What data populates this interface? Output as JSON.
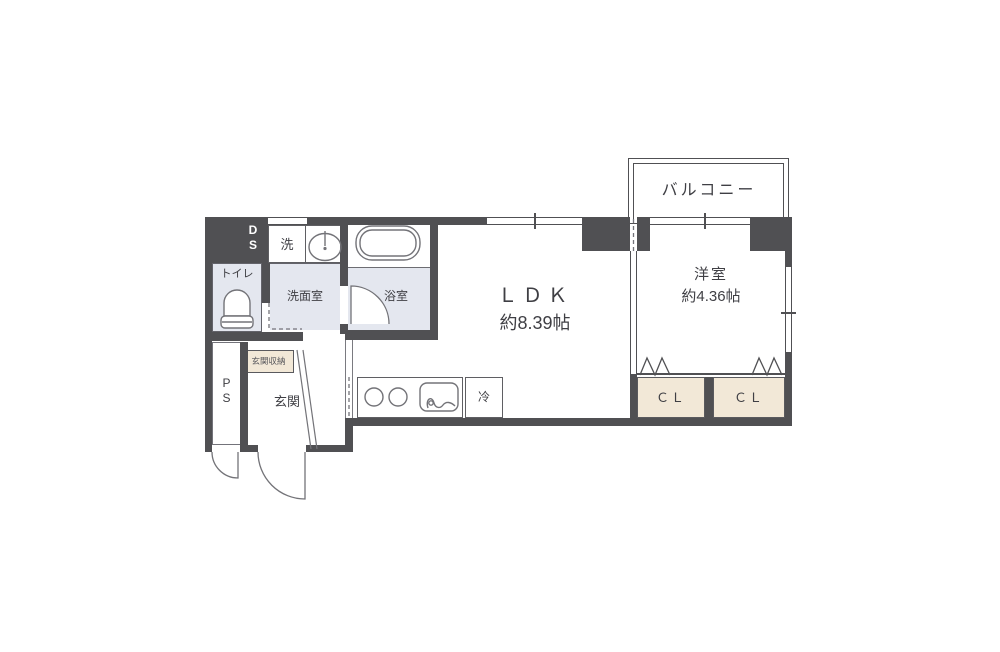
{
  "floor_plan": {
    "balcony": {
      "label": "バルコニー"
    },
    "western_room": {
      "label": "洋室",
      "size": "約4.36帖"
    },
    "ldk": {
      "label": "ＬＤＫ",
      "size": "約8.39帖"
    },
    "closet_left": {
      "label": "ＣＬ"
    },
    "closet_right": {
      "label": "ＣＬ"
    },
    "toilet": {
      "label": "トイレ"
    },
    "washroom": {
      "label": "洗面室"
    },
    "bathroom": {
      "label": "浴室"
    },
    "washer": {
      "label": "洗"
    },
    "fridge": {
      "label": "冷"
    },
    "entrance": {
      "label": "玄関"
    },
    "entrance_storage": {
      "label": "玄関収納"
    },
    "pipe_space": {
      "line1": "P",
      "line2": "S"
    },
    "duct_space": {
      "line1": "D",
      "line2": "S"
    },
    "fixtures": {
      "bathtub": "bathtub-icon",
      "washbasin": "sink-icon",
      "toilet_bowl": "toilet-icon",
      "stove_burners": "stove-burners-icon",
      "kitchen_sink": "kitchen-sink-icon",
      "folding_doors": "folding-door-zigzag-icon",
      "swing_doors": "door-arc-icon"
    },
    "colors": {
      "wall": "#505053",
      "wet_room_tint": "#e4e7ef",
      "closet_tint": "#f2e8d7",
      "fixture_line": "#737378",
      "text": "#3f3f44",
      "background": "#ffffff"
    }
  }
}
